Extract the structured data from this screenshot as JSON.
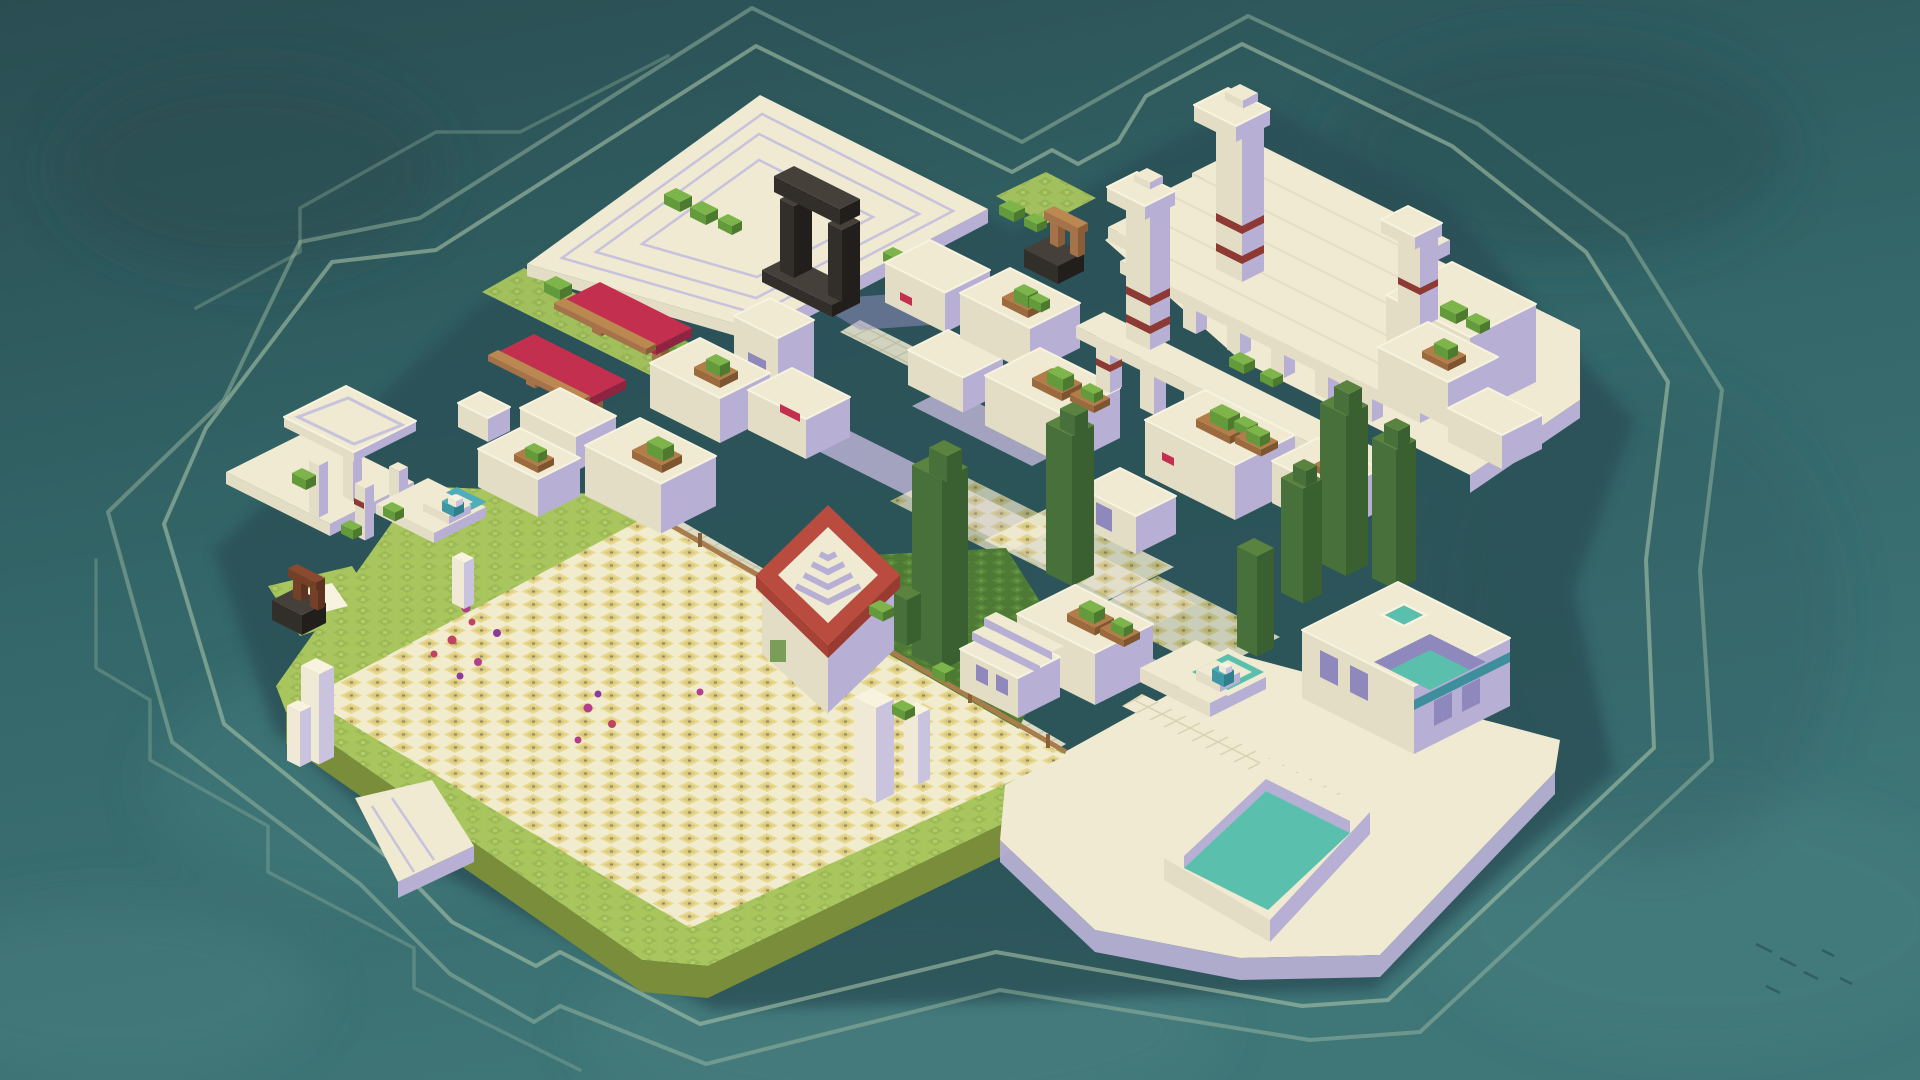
{
  "scene": {
    "type": "isometric-voxel-city-builder-island",
    "viewport": {
      "width": 1920,
      "height": 1080
    }
  },
  "palette": {
    "water-top": "#2A4D52",
    "water-mid": "#336668",
    "water-bottom": "#3F7678",
    "water-cloud-light": "#4D8485",
    "water-cloud-dark": "#27494E",
    "island-shadow": "#294F57",
    "contour": "#A7C1A7",
    "stone-top": "#EFEAD1",
    "stone-lit": "#E4DDC5",
    "stone-shadow": "#B7B0D4",
    "stone-shadow-dark": "#8F88BC",
    "plaza-line": "#C8C2DD",
    "street": "#B9B2D3",
    "tile-grid": "#D9D2B3",
    "cast-shadow": "#9A93C4",
    "red-awning": "#C22F4F",
    "red-band": "#8C3A33",
    "red-frame": "#B94C3E",
    "red-frame-dark": "#993B30",
    "red-frame-lit": "#A84237",
    "wood": "#BC8852",
    "dirt": "#B27D48",
    "bush": "#7DB54A",
    "cypress-light": "#5A833F",
    "cypress": "#47703B",
    "cypress-dark": "#3A5F30",
    "grass": "#A9C55E",
    "grass-dark": "#8FB04C",
    "grass-edge": "#7A8D3A",
    "ivy": "#4E7A35",
    "ivy-light": "#5F8F3E",
    "field": "#E7D88E",
    "field-dark": "#CDBC72",
    "field-grid": "#F2ECCF",
    "field-speck": "#6F6C4C",
    "fence": "#A87C4B",
    "flower-magenta": "#B23E8C",
    "flower-crimson": "#BF4460",
    "flower-purple": "#8C3A9B",
    "pool-water": "#5ABFAC",
    "fountain-water": "#4FAEBA",
    "teal-band": "#3E8E9C",
    "white": "#F7F3DF"
  },
  "features": [
    "ocean",
    "topographic-contour-rings",
    "island-shadow",
    "stepped-plaza",
    "black-arch-monument",
    "market-stalls-red-awnings",
    "banded-white-towers",
    "temple-colonnade",
    "wishing-wells",
    "rooftop-garden-buildings",
    "red-framed-spiral-roof",
    "cypress-trees",
    "pergola-pavilion",
    "tiered-fountains",
    "wheat-field",
    "wooden-fence",
    "flower-clusters",
    "grass-terraces",
    "ivy-slope",
    "swimming-pool",
    "courtyard-pool-house",
    "sun-deck",
    "stone-pillars",
    "boat-dock",
    "statue-shrine"
  ]
}
